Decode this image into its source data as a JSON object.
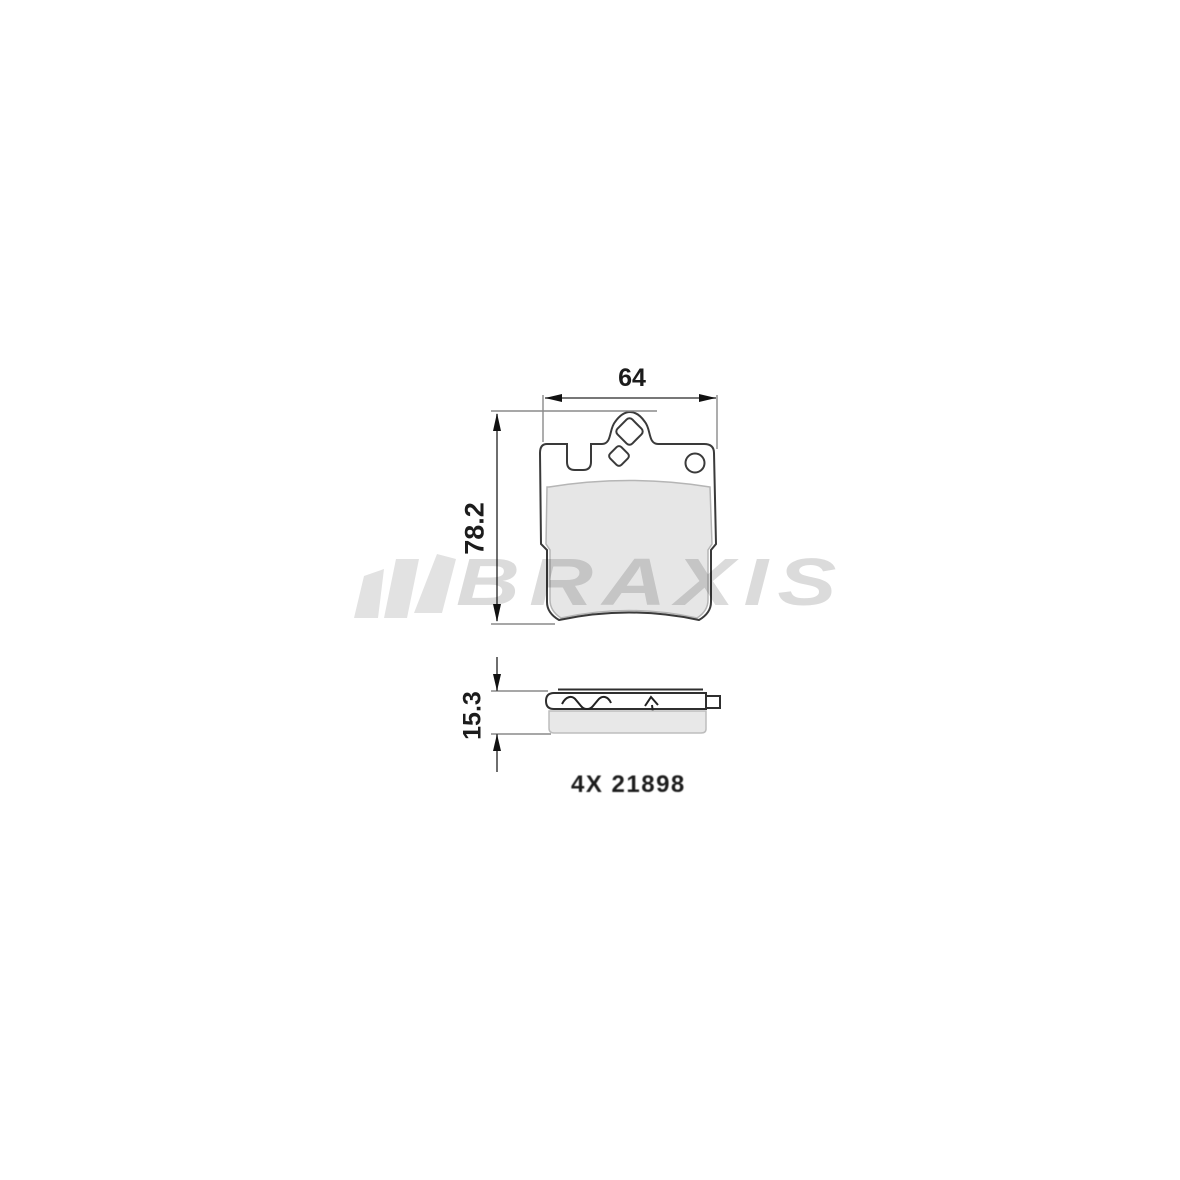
{
  "page": {
    "background_color": "#ffffff"
  },
  "watermark": {
    "brand_text": "BRAXIS",
    "icon": "braxis-fan-icon",
    "text_color": "#dbdbdb",
    "icon_color": "#e2e2e2"
  },
  "drawing": {
    "type": "brake-pad-technical-drawing",
    "front_view": {
      "width_dimension": "64",
      "height_dimension": "78.2"
    },
    "side_view": {
      "thickness_dimension": "15.3"
    },
    "quantity_part_note": "4X 21898",
    "line_color": "#3a3a3a",
    "friction_fill_color": "#e6e6e6",
    "dimension_line_color": "#4a4a4a",
    "extension_line_color": "#8a8a8a"
  }
}
